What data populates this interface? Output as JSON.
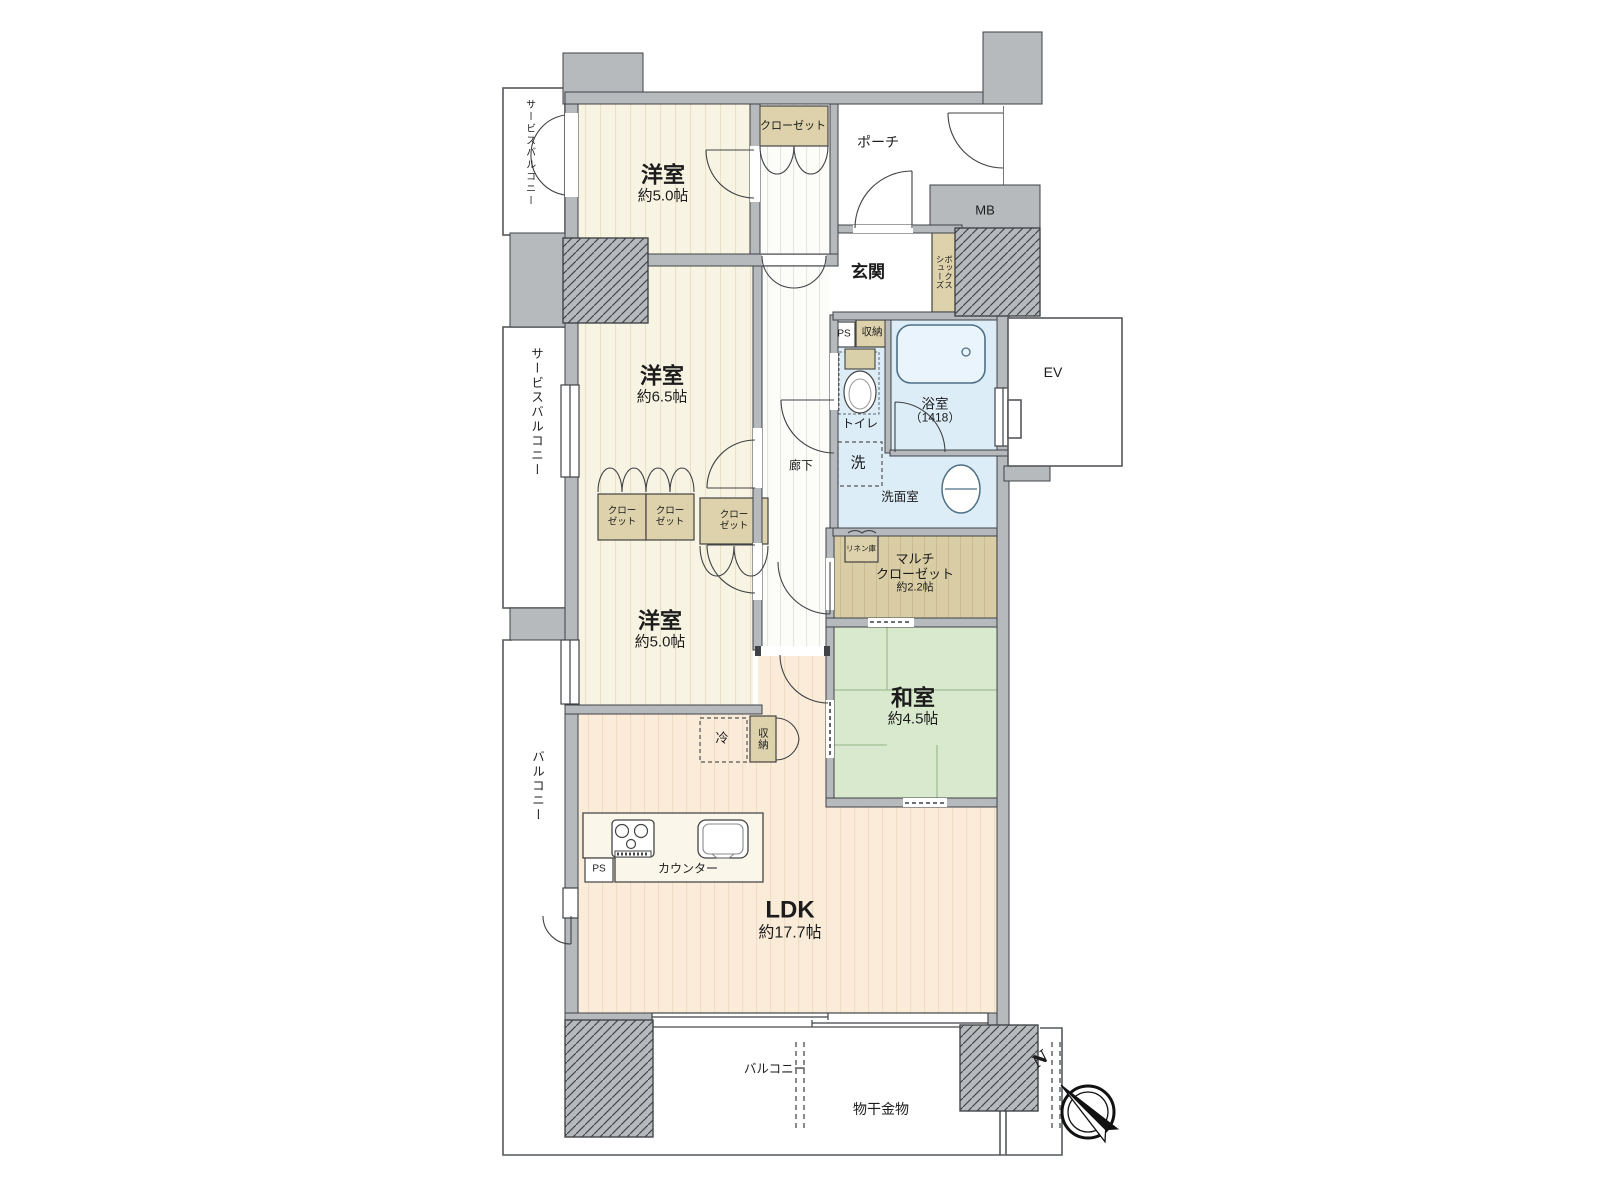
{
  "plan": {
    "rooms": {
      "western_top": {
        "name": "洋室",
        "size": "約5.0帖"
      },
      "western_mid": {
        "name": "洋室",
        "size": "約6.5帖"
      },
      "western_low": {
        "name": "洋室",
        "size": "約5.0帖"
      },
      "japanese": {
        "name": "和室",
        "size": "約4.5帖"
      },
      "ldk": {
        "name": "LDK",
        "size": "約17.7帖"
      },
      "multi_closet": {
        "name_l1": "マルチ",
        "name_l2": "クローゼット",
        "size": "約2.2帖"
      },
      "bath": {
        "name": "浴室",
        "size": "（1418）"
      },
      "washroom": {
        "name": "洗面室"
      },
      "toilet": {
        "name": "トイレ"
      },
      "entrance": {
        "name": "玄関"
      },
      "porch": {
        "name": "ポーチ"
      },
      "corridor": {
        "name": "廊下"
      }
    },
    "features": {
      "closet": "クローゼット",
      "closet_line1": "クロー",
      "closet_line2": "ゼット",
      "shoes_line1": "シューズ",
      "shoes_line2": "ボックス",
      "storage": "収納",
      "linen": "リネン庫",
      "washer": "洗",
      "fridge": "冷",
      "counter": "カウンター",
      "ps": "PS",
      "mb": "MB",
      "ev": "EV",
      "laundry_hw": "物干金物",
      "north": "N"
    },
    "outdoor": {
      "service_balcony": "サービスバルコニー",
      "balcony": "バルコニー"
    },
    "palette": {
      "wall": "#b6babd",
      "outline": "#3f4246",
      "cream_floor": "#f8f4e3",
      "ldk_floor": "#faecd9",
      "tatami": "#d9e9ce",
      "water": "#dcedf7",
      "wood": "#ddd2ab"
    }
  }
}
